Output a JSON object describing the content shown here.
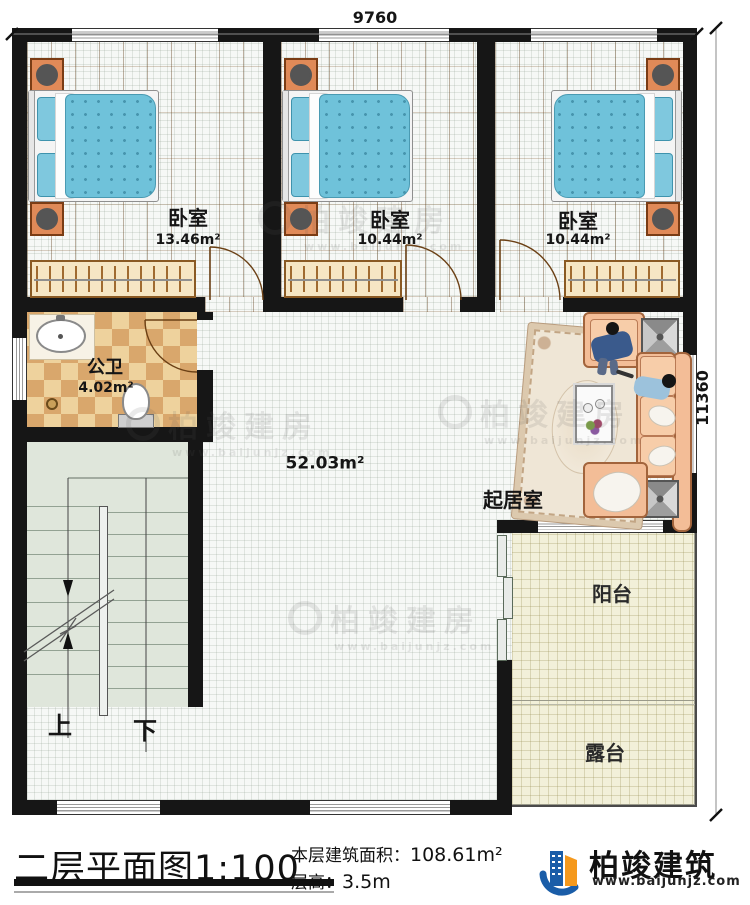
{
  "dimensions": {
    "top": "9760",
    "right": "11360"
  },
  "rooms": {
    "bedroom1": {
      "name": "卧室",
      "area": "13.46m²"
    },
    "bedroom2": {
      "name": "卧室",
      "area": "10.44m²"
    },
    "bedroom3": {
      "name": "卧室",
      "area": "10.44m²"
    },
    "bathroom": {
      "name": "公卫",
      "area": "4.02m²"
    },
    "hall": {
      "area": "52.03m²"
    },
    "living_room": {
      "name": "起居室"
    },
    "balcony": {
      "name": "阳台"
    },
    "terrace": {
      "name": "露台"
    }
  },
  "stairs": {
    "up": "上",
    "down": "下"
  },
  "title_block": {
    "title": "二层平面图",
    "scale": "1:100",
    "floor_area_label": "本层建筑面积：",
    "floor_area_value": "108.61m²",
    "floor_height_label": "层高：",
    "floor_height_value": "3.5m"
  },
  "logo": {
    "name": "柏竣建筑",
    "website": "www.baijunjz.com"
  },
  "watermark": {
    "text": "柏竣建房",
    "website": "www.baijunjz.com"
  },
  "colors": {
    "wall": "#161616",
    "wood": "#b0793c",
    "bed_blue": "#6fc2da",
    "sofa_peach": "#f3bd97",
    "logo_blue": "#1a5da8",
    "logo_orange": "#f5991d"
  }
}
